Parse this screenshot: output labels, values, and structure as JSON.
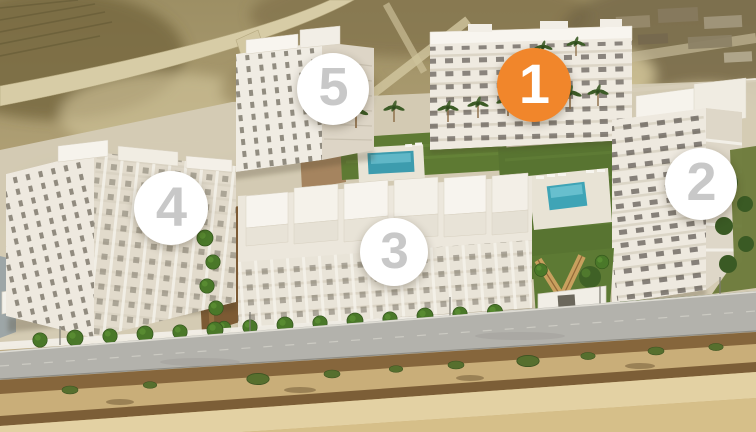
{
  "scene": {
    "alt": "Aerial 3D render of a white residential complex with five numbered apartment buildings, landscaped gardens with two swimming pools, palm trees, a perimeter road and surrounding dry scrubland"
  },
  "badges": [
    {
      "label": "1",
      "bg": "#F1862B",
      "fg": "#FFFFFF",
      "highlighted": true
    },
    {
      "label": "2",
      "bg": "#FFFFFF",
      "fg": "#C8C8C8",
      "highlighted": false
    },
    {
      "label": "3",
      "bg": "#FFFFFF",
      "fg": "#C8C8C8",
      "highlighted": false
    },
    {
      "label": "4",
      "bg": "#FFFFFF",
      "fg": "#C8C8C8",
      "highlighted": false
    },
    {
      "label": "5",
      "bg": "#FFFFFF",
      "fg": "#C8C8C8",
      "highlighted": false
    }
  ],
  "palette": {
    "accent_orange": "#F1862B",
    "badge_number_gray": "#C8C8C8",
    "ground_tan": "#B0A078",
    "scrub_olive": "#6E6136",
    "building_white": "#EFEAE0",
    "lawn_green": "#5E7A33",
    "pool_turquoise": "#3FA4B6",
    "path_brown": "#7C5A34",
    "road_gray": "#B3B2AC",
    "embankment_sand": "#C9AE79"
  }
}
